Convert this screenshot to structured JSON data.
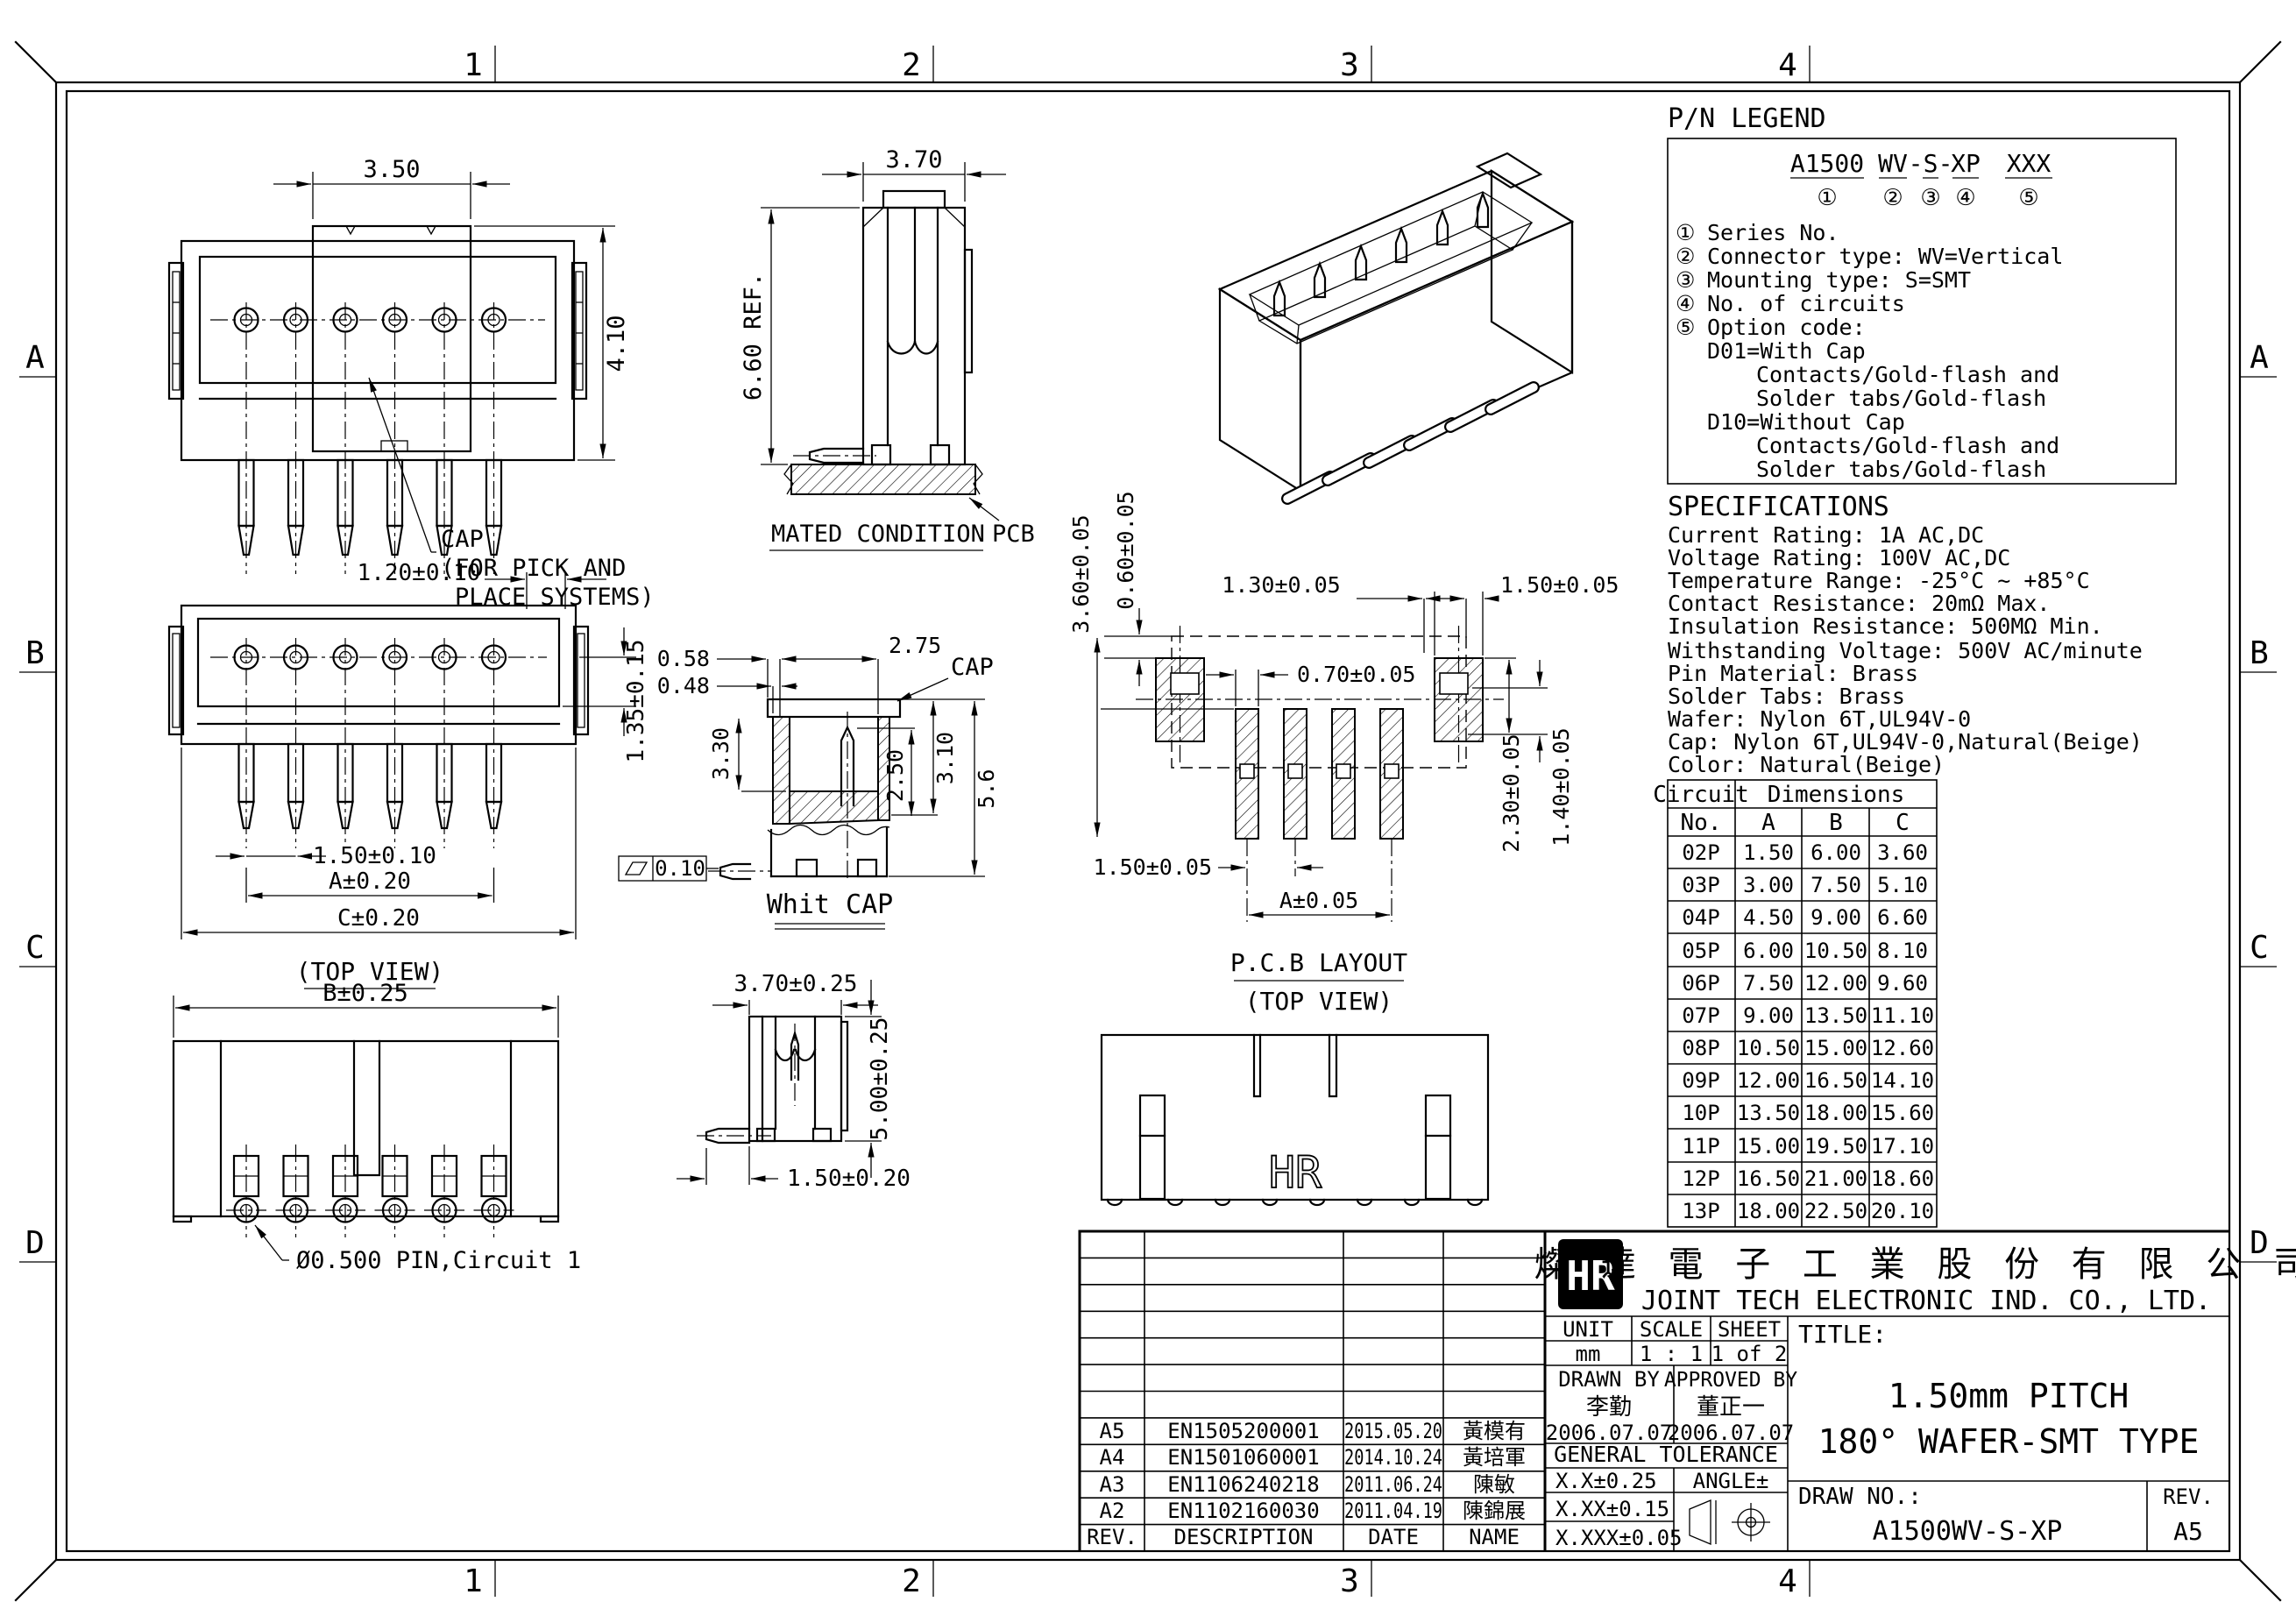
{
  "colors": {
    "ink": "#000000",
    "paper": "#ffffff"
  },
  "sheet": {
    "zones_h": [
      "1",
      "2",
      "3",
      "4"
    ],
    "zones_v": [
      "A",
      "B",
      "C",
      "D"
    ]
  },
  "views": {
    "front_top": {
      "dim_width": "3.50",
      "dim_height": "4.10",
      "cap_line1": "CAP",
      "cap_line2": "(FOR PICK AND",
      "cap_line3": "PLACE SYSTEMS)"
    },
    "mated": {
      "dim_width": "3.70",
      "dim_height": "6.60 REF.",
      "caption": "MATED CONDITION",
      "pcb_label": "PCB"
    },
    "top_view": {
      "dim_edge": "1.20±0.10",
      "dim_side": "1.35±0.15",
      "dim_pitch": "1.50±0.10",
      "dim_a": "A±0.20",
      "dim_c": "C±0.20",
      "caption": "(TOP VIEW)"
    },
    "whit_cap": {
      "dim_058": "0.58",
      "dim_048": "0.48",
      "dim_275": "2.75",
      "cap_label": "CAP",
      "dim_330": "3.30",
      "dim_250": "2.50",
      "dim_310": "3.10",
      "dim_56": "5.6",
      "flatness": "0.10",
      "caption": "Whit CAP"
    },
    "pcb_layout": {
      "dim_060": "0.60±0.05",
      "dim_360": "3.60±0.05",
      "dim_130": "1.30±0.05",
      "dim_150_right": "1.50±0.05",
      "dim_070": "0.70±0.05",
      "dim_230": "2.30±0.05",
      "dim_140": "1.40±0.05",
      "dim_150_left": "1.50±0.05",
      "dim_a": "A±0.05",
      "caption1": "P.C.B LAYOUT",
      "caption2": "(TOP VIEW)"
    },
    "bottom_view": {
      "dim_b": "B±0.25",
      "pin_note": "Ø0.500 PIN,Circuit 1"
    },
    "side_view": {
      "dim_width": "3.70±0.25",
      "dim_height": "5.00±0.25",
      "dim_lead": "1.50±0.20"
    },
    "front_hr": {
      "marking": "HR"
    }
  },
  "legend": {
    "title": "P/N LEGEND",
    "pn": {
      "segments": [
        "A1500",
        "WV",
        "S",
        "XP",
        "XXX"
      ],
      "sep": "-"
    },
    "circles": [
      "①",
      "②",
      "③",
      "④",
      "⑤"
    ],
    "lines": [
      {
        "bullet": "①",
        "text": "Series No."
      },
      {
        "bullet": "②",
        "text": "Connector type: WV=Vertical"
      },
      {
        "bullet": "③",
        "text": "Mounting type: S=SMT"
      },
      {
        "bullet": "④",
        "text": "No. of circuits"
      },
      {
        "bullet": "⑤",
        "text": "Option code:"
      },
      {
        "bullet": "",
        "text": "D01=With Cap"
      },
      {
        "bullet": "",
        "text": "Contacts/Gold-flash and"
      },
      {
        "bullet": "",
        "text": "Solder tabs/Gold-flash"
      },
      {
        "bullet": "",
        "text": "D10=Without Cap"
      },
      {
        "bullet": "",
        "text": "Contacts/Gold-flash and"
      },
      {
        "bullet": "",
        "text": "Solder tabs/Gold-flash"
      }
    ]
  },
  "specs": {
    "title": "SPECIFICATIONS",
    "lines": [
      "Current Rating: 1A AC,DC",
      "Voltage Rating: 100V AC,DC",
      "Temperature Range: -25°C ~ +85°C",
      "Contact Resistance: 20mΩ Max.",
      "Insulation Resistance: 500MΩ Min.",
      "Withstanding Voltage: 500V AC/minute",
      "Pin Material: Brass",
      "Solder Tabs: Brass",
      "Wafer: Nylon 6T,UL94V-0",
      "Cap: Nylon 6T,UL94V-0,Natural(Beige)",
      "Color: Natural(Beige)"
    ]
  },
  "dim_table": {
    "header_circuit": "Circuit",
    "header_dimensions": "Dimensions",
    "header_no": "No.",
    "header_a": "A",
    "header_b": "B",
    "header_c": "C",
    "rows": [
      {
        "no": "02P",
        "a": "1.50",
        "b": "6.00",
        "c": "3.60"
      },
      {
        "no": "03P",
        "a": "3.00",
        "b": "7.50",
        "c": "5.10"
      },
      {
        "no": "04P",
        "a": "4.50",
        "b": "9.00",
        "c": "6.60"
      },
      {
        "no": "05P",
        "a": "6.00",
        "b": "10.50",
        "c": "8.10"
      },
      {
        "no": "06P",
        "a": "7.50",
        "b": "12.00",
        "c": "9.60"
      },
      {
        "no": "07P",
        "a": "9.00",
        "b": "13.50",
        "c": "11.10"
      },
      {
        "no": "08P",
        "a": "10.50",
        "b": "15.00",
        "c": "12.60"
      },
      {
        "no": "09P",
        "a": "12.00",
        "b": "16.50",
        "c": "14.10"
      },
      {
        "no": "10P",
        "a": "13.50",
        "b": "18.00",
        "c": "15.60"
      },
      {
        "no": "11P",
        "a": "15.00",
        "b": "19.50",
        "c": "17.10"
      },
      {
        "no": "12P",
        "a": "16.50",
        "b": "21.00",
        "c": "18.60"
      },
      {
        "no": "13P",
        "a": "18.00",
        "b": "22.50",
        "c": "20.10"
      }
    ]
  },
  "revision_table": {
    "headers": {
      "rev": "REV.",
      "description": "DESCRIPTION",
      "date": "DATE",
      "name": "NAME"
    },
    "rows": [
      {
        "rev": "A5",
        "description": "EN1505200001",
        "date": "2015.05.20",
        "name": "黃模有"
      },
      {
        "rev": "A4",
        "description": "EN1501060001",
        "date": "2014.10.24",
        "name": "黃培軍"
      },
      {
        "rev": "A3",
        "description": "EN1106240218",
        "date": "2011.06.24",
        "name": "陳敏"
      },
      {
        "rev": "A2",
        "description": "EN1102160030",
        "date": "2011.04.19",
        "name": "陳錦展"
      }
    ]
  },
  "title_block": {
    "logo_text": "HR",
    "company_cn": "燦 達 電 子 工 業 股 份 有 限 公 司",
    "company_en": "JOINT TECH ELECTRONIC IND. CO., LTD.",
    "unit_label": "UNIT",
    "unit_value": "mm",
    "scale_label": "SCALE",
    "scale_value": "1 : 1",
    "sheet_label": "SHEET",
    "sheet_value": "1 of 2",
    "drawn_by_label": "DRAWN BY",
    "drawn_by_name": "李勤",
    "drawn_by_date": "2006.07.07",
    "approved_by_label": "APPROVED BY",
    "approved_by_name": "董正一",
    "approved_by_date": "2006.07.07",
    "general_tolerance": "GENERAL TOLERANCE",
    "tol1": "X.X±0.25",
    "tol2": "X.XX±0.15",
    "tol3": "X.XXX±0.05",
    "angle_label": "ANGLE±",
    "title_label": "TITLE:",
    "title_line1": "1.50mm PITCH",
    "title_line2": "180° WAFER-SMT TYPE",
    "draw_no_label": "DRAW NO.:",
    "draw_no_value": "A1500WV-S-XP",
    "rev_label": "REV.",
    "rev_value": "A5"
  }
}
